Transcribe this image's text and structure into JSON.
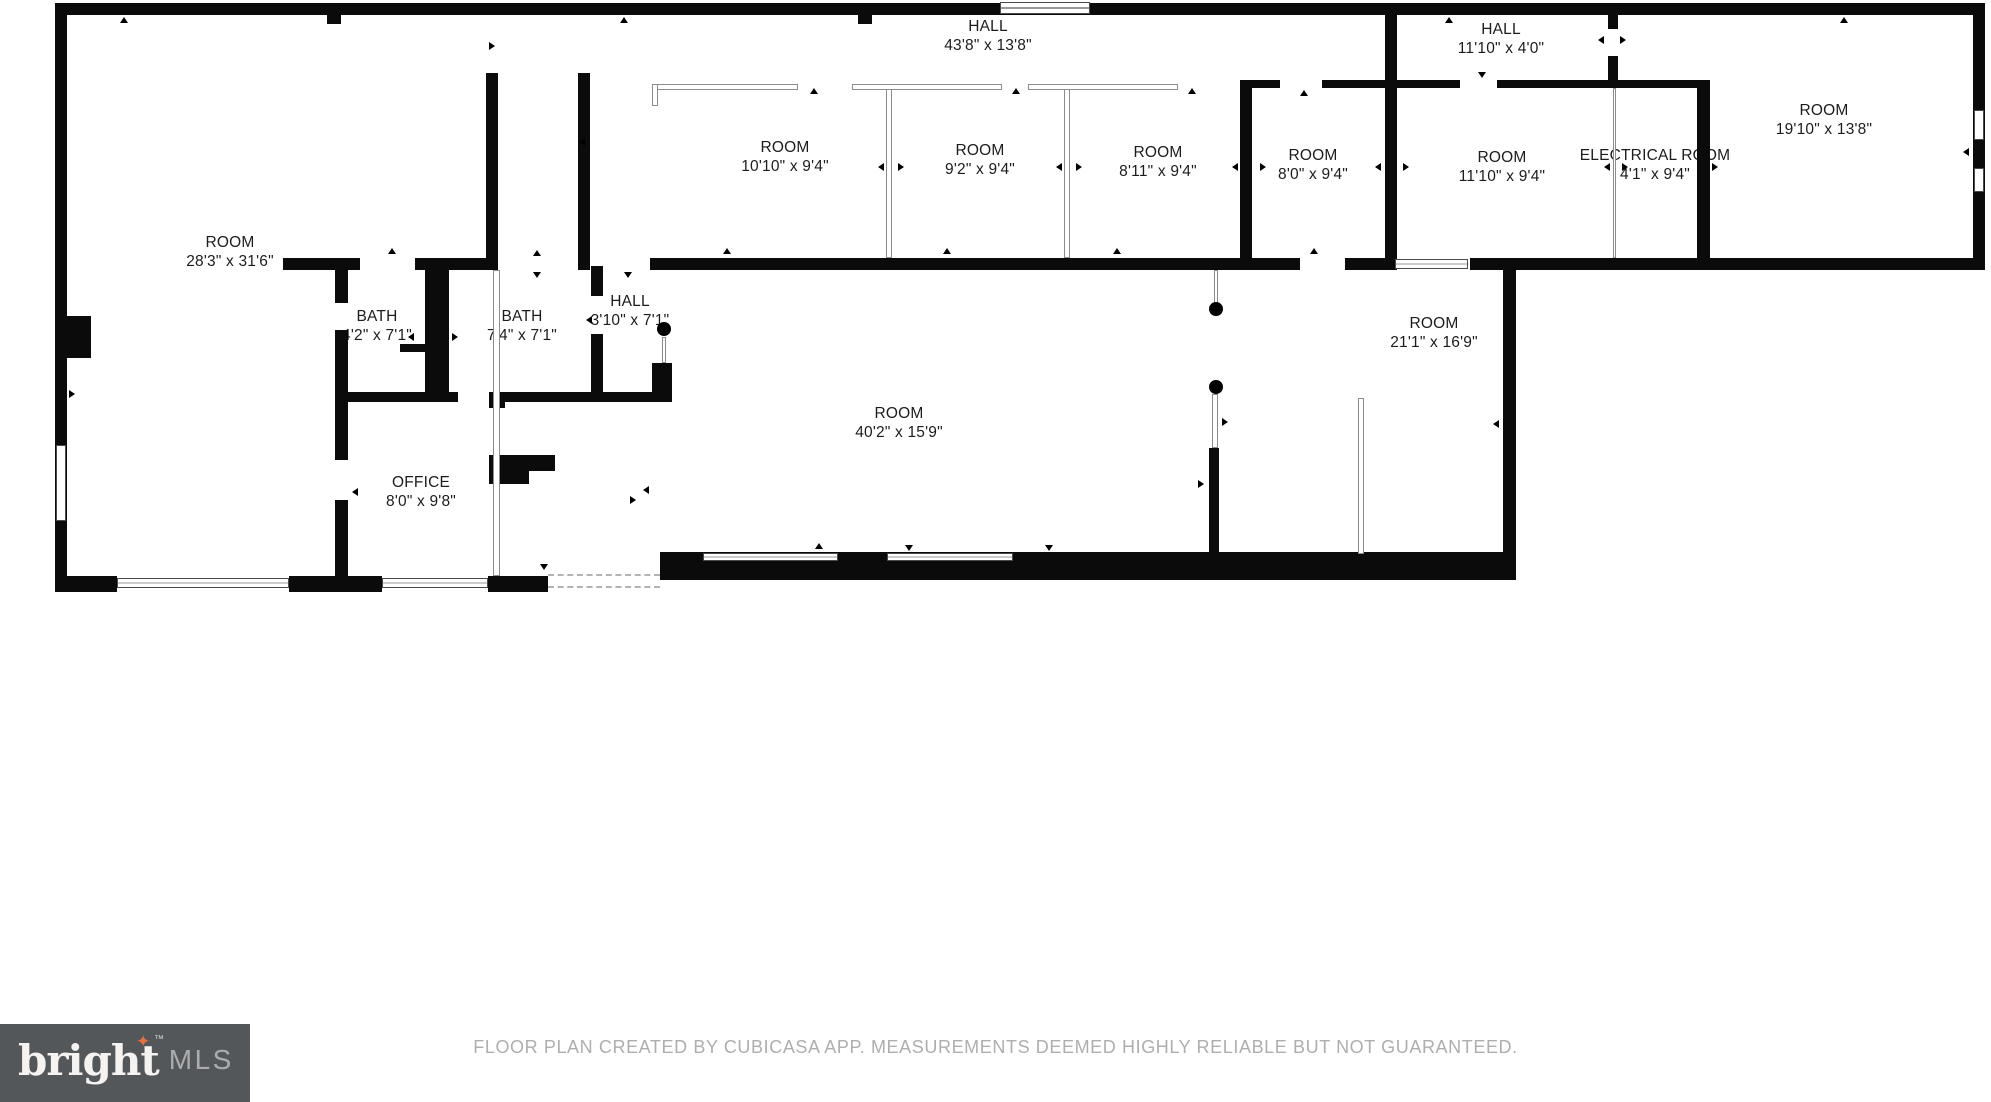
{
  "plan": {
    "rooms": [
      {
        "name": "HALL",
        "dims": "43'8\" x 13'8\""
      },
      {
        "name": "HALL",
        "dims": "11'10\" x 4'0\""
      },
      {
        "name": "ROOM",
        "dims": "10'10\" x 9'4\""
      },
      {
        "name": "ROOM",
        "dims": "9'2\" x 9'4\""
      },
      {
        "name": "ROOM",
        "dims": "8'11\" x 9'4\""
      },
      {
        "name": "ROOM",
        "dims": "8'0\" x 9'4\""
      },
      {
        "name": "ROOM",
        "dims": "11'10\" x 9'4\""
      },
      {
        "name": "ELECTRICAL ROOM",
        "dims": "4'1\" x 9'4\""
      },
      {
        "name": "ROOM",
        "dims": "19'10\" x 13'8\""
      },
      {
        "name": "ROOM",
        "dims": "28'3\" x 31'6\""
      },
      {
        "name": "BATH",
        "dims": "4'2\" x 7'1\""
      },
      {
        "name": "BATH",
        "dims": "7'4\" x 7'1\""
      },
      {
        "name": "HALL",
        "dims": "3'10\" x 7'1\""
      },
      {
        "name": "ROOM",
        "dims": "21'1\" x 16'9\""
      },
      {
        "name": "ROOM",
        "dims": "40'2\" x 15'9\""
      },
      {
        "name": "OFFICE",
        "dims": "8'0\" x 9'8\""
      }
    ],
    "colors": {
      "wall": "#0b0b0b",
      "label_text": "#1c1c1c"
    }
  },
  "footer": {
    "disclaimer": "FLOOR PLAN CREATED BY CUBICASA APP. MEASUREMENTS DEEMED HIGHLY RELIABLE BUT NOT GUARANTEED.",
    "logo": {
      "brand": "bright",
      "tm": "™",
      "suffix": "MLS",
      "star_icon": "✦"
    },
    "colors": {
      "logo_bg": "#54575a",
      "logo_star": "#e8713a",
      "disclaimer_text": "#aeaeae"
    }
  }
}
